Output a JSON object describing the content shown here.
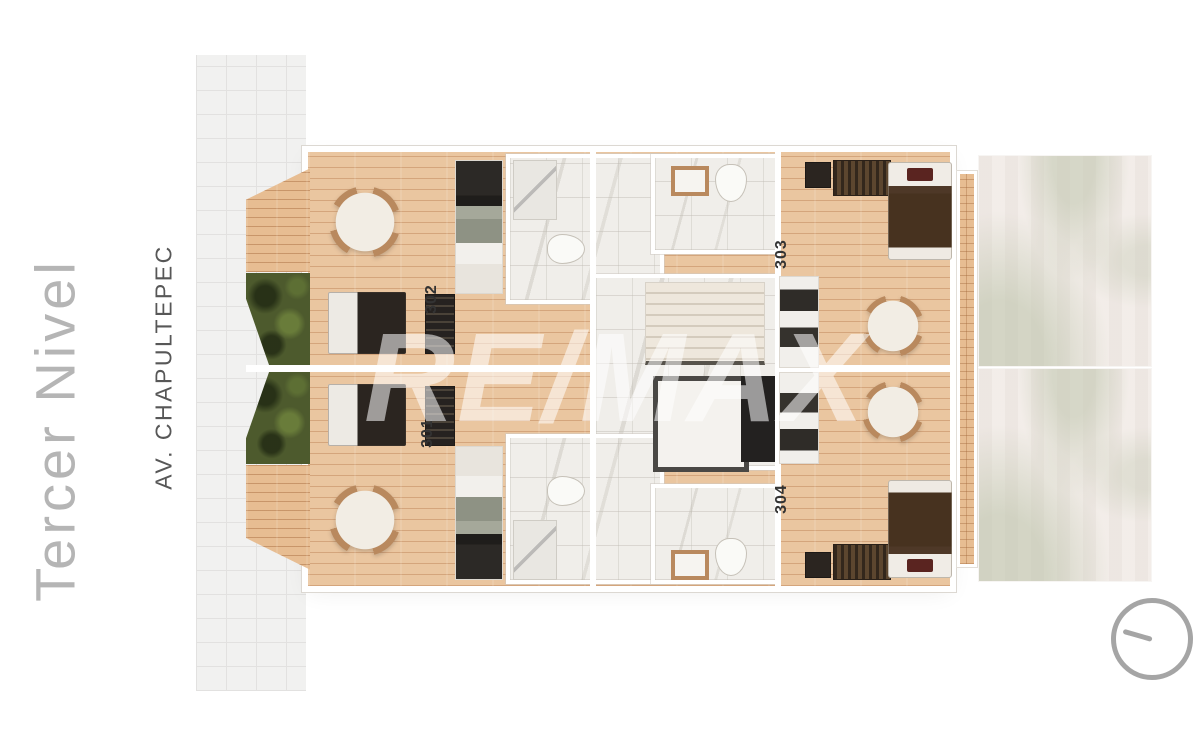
{
  "titles": {
    "level": "Tercer Nivel",
    "street": "AV. CHAPULTEPEC"
  },
  "watermark": {
    "text": "RE/MAX"
  },
  "plan": {
    "units": [
      {
        "number": "301"
      },
      {
        "number": "302"
      },
      {
        "number": "303"
      },
      {
        "number": "304"
      }
    ]
  },
  "colors": {
    "wood": "#eac6a0",
    "wood-line": "#c98f5e",
    "deck": "#e7bd92",
    "marble": "#f0eeea",
    "green": "#4d5a2d",
    "wall": "#ffffff",
    "dark": "#2b2520",
    "blanket": "#47321f",
    "maroon": "#5a2420",
    "tan": "#b9895e",
    "sidewalk": "#f1f1f0",
    "sidewalk-line": "#e2e1e0",
    "level-text": "#b5b5b5",
    "street-text": "#575757",
    "unit-text": "#333333",
    "compass": "#a5a5a5",
    "watermark": "rgba(255,255,255,0.55)"
  }
}
